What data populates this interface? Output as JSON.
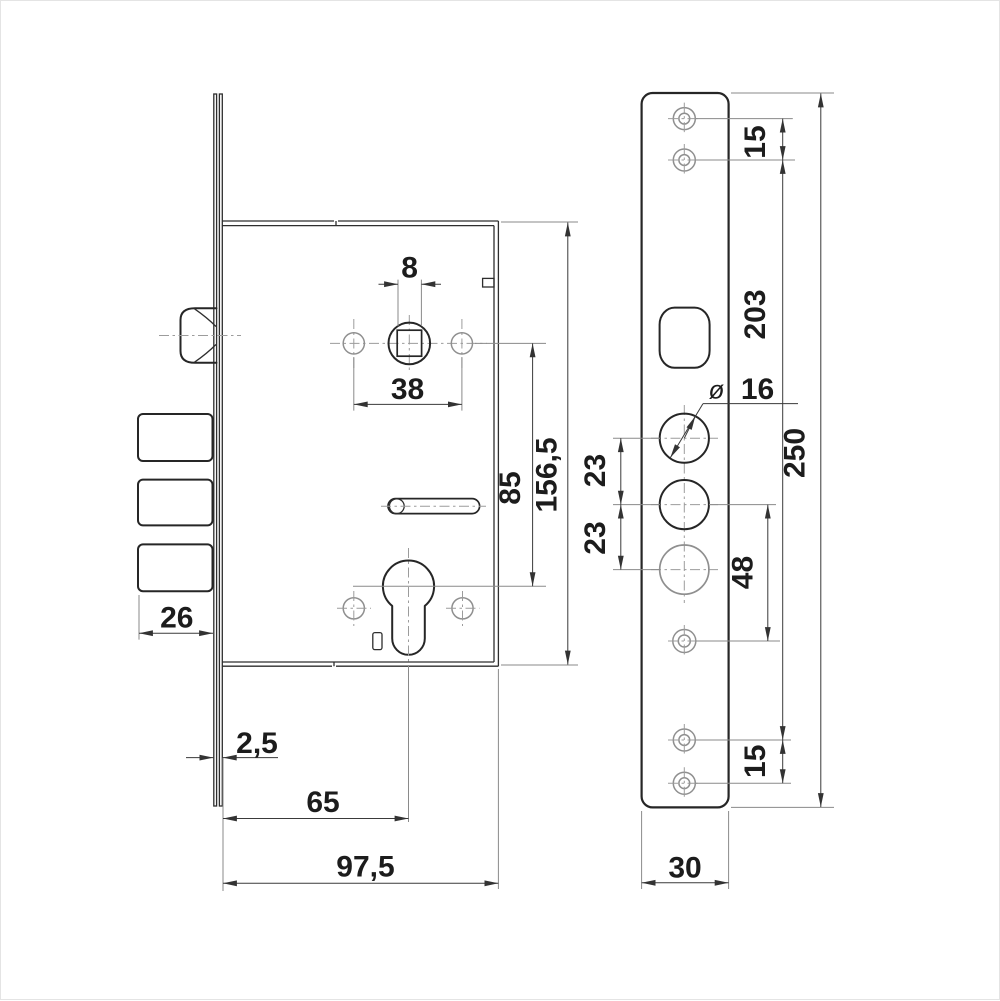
{
  "colors": {
    "background": "#ffffff",
    "frame": "#e4e4e4",
    "line_dark": "#262626",
    "line_dim": "#3a3a3a",
    "line_light": "#8f8f8f",
    "text": "#1c1c1c"
  },
  "left_view": {
    "dims": {
      "spindle_square": "8",
      "handle_fixing_spacing": "38",
      "hub_to_cylinder": "85",
      "case_height": "156,5",
      "bolt_throw": "26",
      "faceplate_thickness": "2,5",
      "backset": "65",
      "case_depth": "97,5"
    }
  },
  "right_view": {
    "dims": {
      "screw_pitch_top": "15",
      "screw_span": "203",
      "diameter_symbol": "ø",
      "bolt_hole_diameter": "16",
      "bolt_pitch_upper": "23",
      "bolt_pitch_lower": "23",
      "bolt_to_screw": "48",
      "faceplate_length": "250",
      "screw_pitch_bottom": "15",
      "faceplate_width": "30"
    }
  }
}
